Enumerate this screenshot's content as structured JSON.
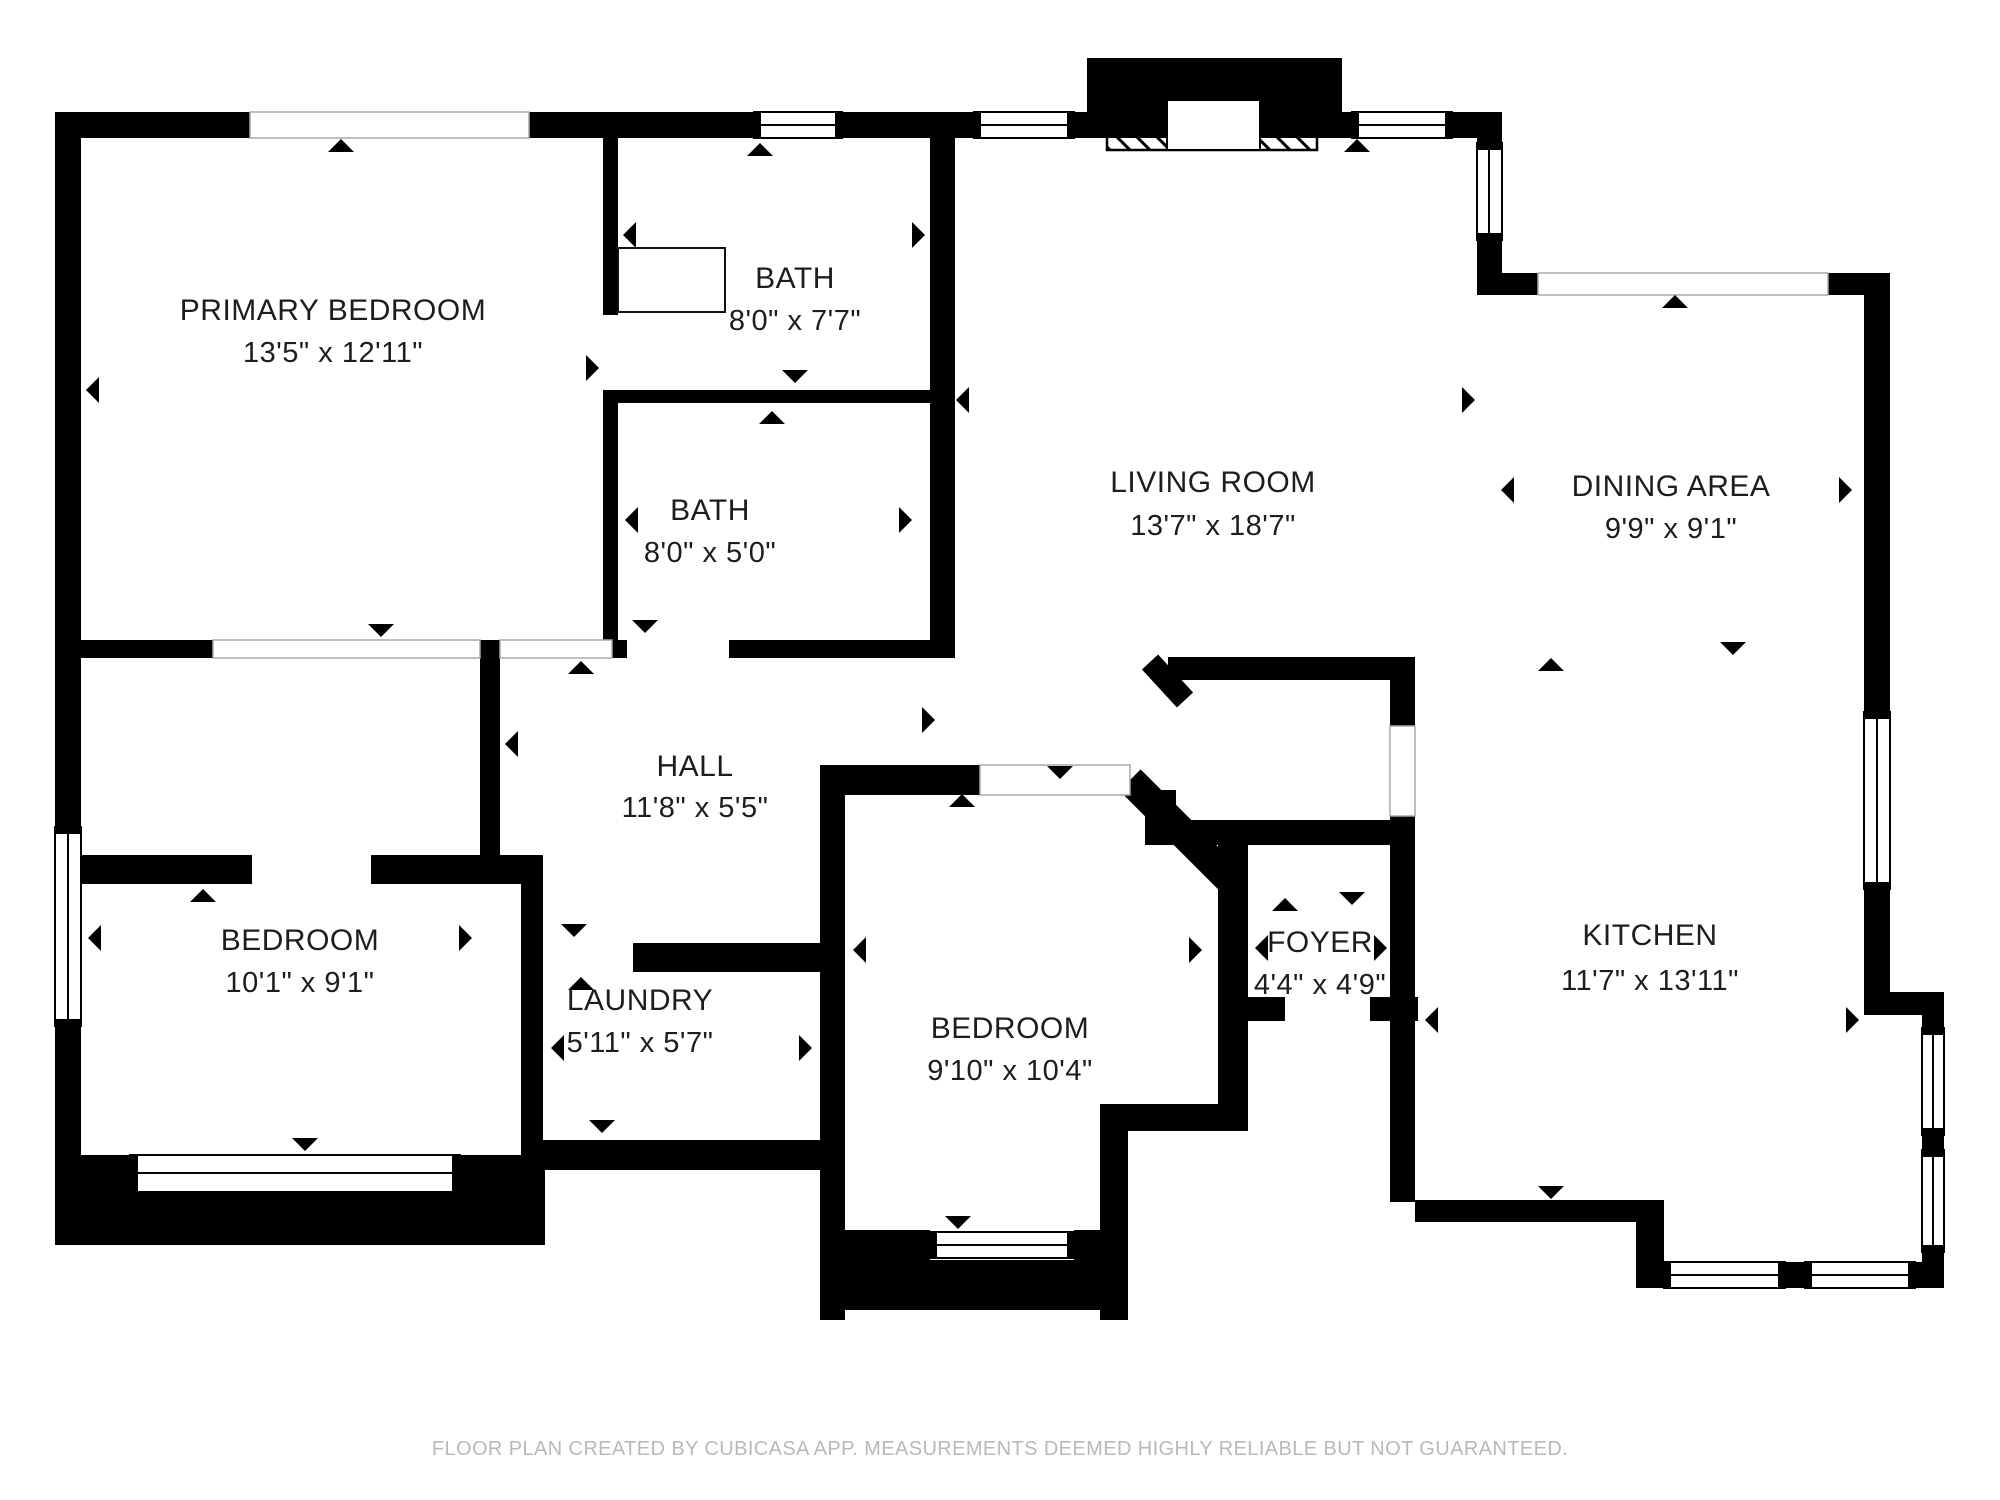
{
  "plan": {
    "creator_note": "FLOOR PLAN CREATED BY CUBICASA APP. MEASUREMENTS DEEMED HIGHLY RELIABLE BUT NOT GUARANTEED."
  },
  "rooms": [
    {
      "id": "primary-bedroom",
      "name": "PRIMARY BEDROOM",
      "dims": "13'5\" x 12'11\""
    },
    {
      "id": "bath-upper",
      "name": "BATH",
      "dims": "8'0\" x 7'7\""
    },
    {
      "id": "bath-lower",
      "name": "BATH",
      "dims": "8'0\" x 5'0\""
    },
    {
      "id": "living-room",
      "name": "LIVING ROOM",
      "dims": "13'7\" x 18'7\""
    },
    {
      "id": "dining-area",
      "name": "DINING AREA",
      "dims": "9'9\" x 9'1\""
    },
    {
      "id": "hall",
      "name": "HALL",
      "dims": "11'8\" x 5'5\""
    },
    {
      "id": "bedroom-left",
      "name": "BEDROOM",
      "dims": "10'1\" x 9'1\""
    },
    {
      "id": "laundry",
      "name": "LAUNDRY",
      "dims": "5'11\" x 5'7\""
    },
    {
      "id": "bedroom-middle",
      "name": "BEDROOM",
      "dims": "9'10\" x 10'4\""
    },
    {
      "id": "foyer",
      "name": "FOYER",
      "dims": "4'4\" x 4'9\""
    },
    {
      "id": "kitchen",
      "name": "KITCHEN",
      "dims": "11'7\" x 13'11\""
    }
  ],
  "footer": {
    "disclaimer": "FLOOR PLAN CREATED BY CUBICASA APP. MEASUREMENTS DEEMED HIGHLY RELIABLE BUT NOT GUARANTEED."
  }
}
